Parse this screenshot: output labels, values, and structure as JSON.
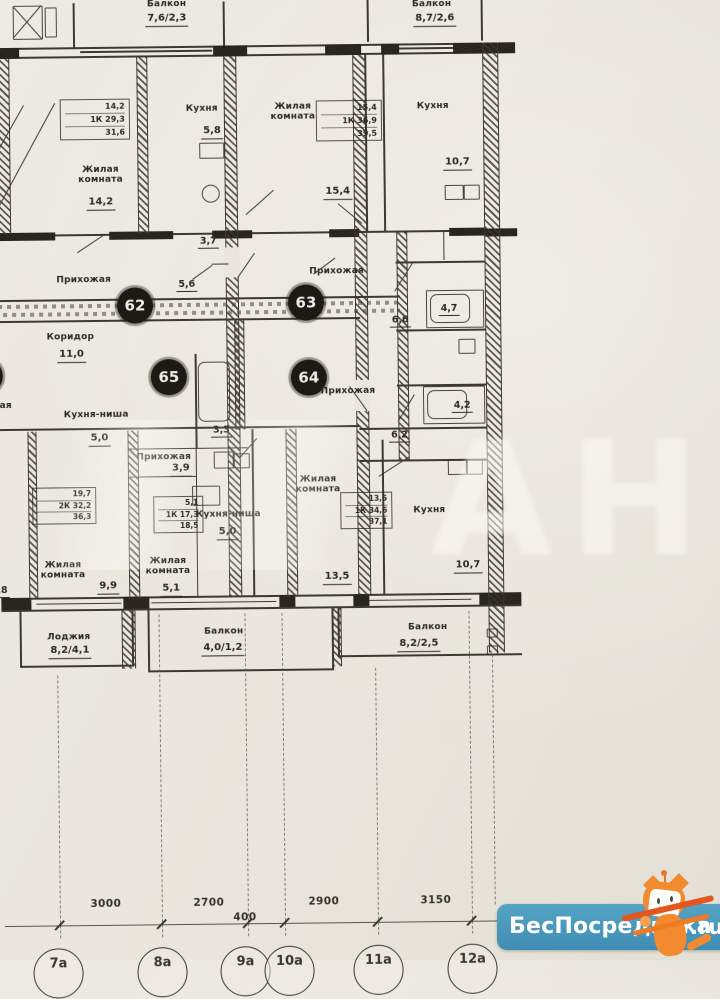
{
  "plan": {
    "top_balconies": [
      {
        "name": "Балкон",
        "area": "7,6/2,3"
      },
      {
        "name": "Балкон",
        "area": "8,7/2,6"
      }
    ],
    "bottom_balconies": [
      {
        "name": "Лоджия",
        "area": "8,2/4,1"
      },
      {
        "name": "Балкон",
        "area": "4,0/1,2"
      },
      {
        "name": "Балкон",
        "area": "8,2/2,5"
      }
    ],
    "units": [
      "62",
      "63",
      "64",
      "65"
    ],
    "stamps": [
      {
        "rows": [
          "14,2",
          "1К 29,3",
          "31,6"
        ]
      },
      {
        "rows": [
          "15,4",
          "1К 36,9",
          "39,5"
        ]
      },
      {
        "rows": [
          "19,7",
          "2К 32,2",
          "36,3"
        ]
      },
      {
        "rows": [
          "5,1",
          "1К 17,3",
          "18,5"
        ]
      },
      {
        "rows": [
          "13,5",
          "1К 34,6",
          "37,1"
        ]
      }
    ],
    "rooms": [
      {
        "name": "Жилая комната",
        "area": "14,2"
      },
      {
        "name": "Кухня",
        "area": "5,8"
      },
      {
        "name": "Жилая комната",
        "area": "15,4"
      },
      {
        "name": "Кухня",
        "area": "10,7"
      },
      {
        "name": "Прихожая",
        "area": ""
      },
      {
        "name": "Прихожая",
        "area": ""
      },
      {
        "name": "Коридор",
        "area": "11,0"
      },
      {
        "name": "Прихожая",
        "area": ""
      },
      {
        "name": "Кухня-ниша",
        "area": "5,0"
      },
      {
        "name": "Прихожая",
        "area": "3,9"
      },
      {
        "name": "Кухня-ниша",
        "area": "5,0"
      },
      {
        "name": "Жилая комната",
        "area": "9,9"
      },
      {
        "name": "Жилая комната",
        "area": "5,1"
      },
      {
        "name": "Жилая комната",
        "area": "13,5"
      },
      {
        "name": "Кухня",
        "area": "10,7"
      }
    ],
    "small_dims": [
      "3,7",
      "5,6",
      "6,6",
      "4,7",
      "4,2",
      "6,2",
      "3,3"
    ],
    "edge_fragments": [
      "жая",
      "9,8"
    ]
  },
  "dimensions": {
    "values": [
      "3000",
      "2700",
      "400",
      "2900",
      "3150"
    ]
  },
  "axes": {
    "labels": [
      "7а",
      "8а",
      "9а",
      "10а",
      "11а",
      "12а"
    ]
  },
  "watermark": {
    "text": "АН"
  },
  "badge": {
    "text": "БесПосредника",
    "suffix": ".ru"
  }
}
